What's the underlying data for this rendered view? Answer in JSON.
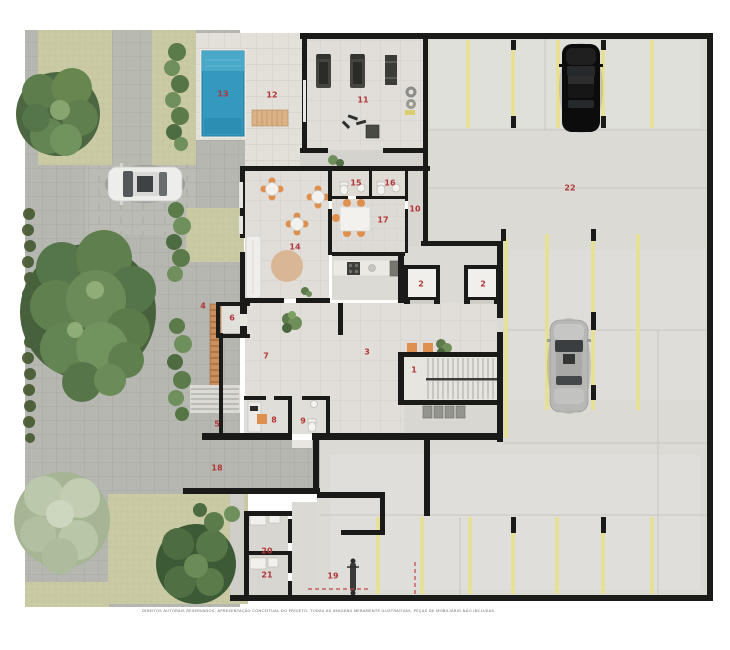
{
  "caption": "DIREITOS AUTORAIS RESERVADOS. APRESENTAÇÃO CONCEITUAL DO PROJETO. TODAS AS IMAGENS MERAMENTE ILUSTRATIVAS. PEÇAS DE MOBILIÁRIO NÃO INCLUSAS.",
  "plan": {
    "type": "residential-ground-floor-site-plan",
    "room_labels": [
      {
        "label": "13",
        "x": 223,
        "y": 94
      },
      {
        "label": "12",
        "x": 272,
        "y": 95
      },
      {
        "label": "11",
        "x": 363,
        "y": 100
      },
      {
        "label": "22",
        "x": 570,
        "y": 188
      },
      {
        "label": "15",
        "x": 356,
        "y": 183
      },
      {
        "label": "16",
        "x": 390,
        "y": 183
      },
      {
        "label": "10",
        "x": 415,
        "y": 209
      },
      {
        "label": "17",
        "x": 383,
        "y": 220
      },
      {
        "label": "14",
        "x": 295,
        "y": 247
      },
      {
        "label": "2",
        "x": 421,
        "y": 284
      },
      {
        "label": "2",
        "x": 483,
        "y": 284
      },
      {
        "label": "4",
        "x": 203,
        "y": 306
      },
      {
        "label": "6",
        "x": 232,
        "y": 318
      },
      {
        "label": "7",
        "x": 266,
        "y": 356
      },
      {
        "label": "3",
        "x": 367,
        "y": 352
      },
      {
        "label": "1",
        "x": 414,
        "y": 370
      },
      {
        "label": "5",
        "x": 217,
        "y": 424
      },
      {
        "label": "8",
        "x": 274,
        "y": 420
      },
      {
        "label": "9",
        "x": 303,
        "y": 421
      },
      {
        "label": "18",
        "x": 217,
        "y": 468
      },
      {
        "label": "20",
        "x": 267,
        "y": 551
      },
      {
        "label": "21",
        "x": 267,
        "y": 575
      },
      {
        "label": "19",
        "x": 333,
        "y": 576
      }
    ],
    "palette": {
      "label_red": "#b23537",
      "pool_blue": "#3598bf",
      "parking_line_yellow": "#e7e18f",
      "wall_black": "#1a1a19",
      "lawn_khaki": "#c9c9a3",
      "concrete": "#dbdad5",
      "paver_gray": "#b6b7b1",
      "furniture_orange": "#e0904e",
      "ramp_brick": "#c98f5f",
      "car_black": "#0c0c0c",
      "car_silver": "#b7b8b6",
      "car_white": "#ededec"
    }
  }
}
